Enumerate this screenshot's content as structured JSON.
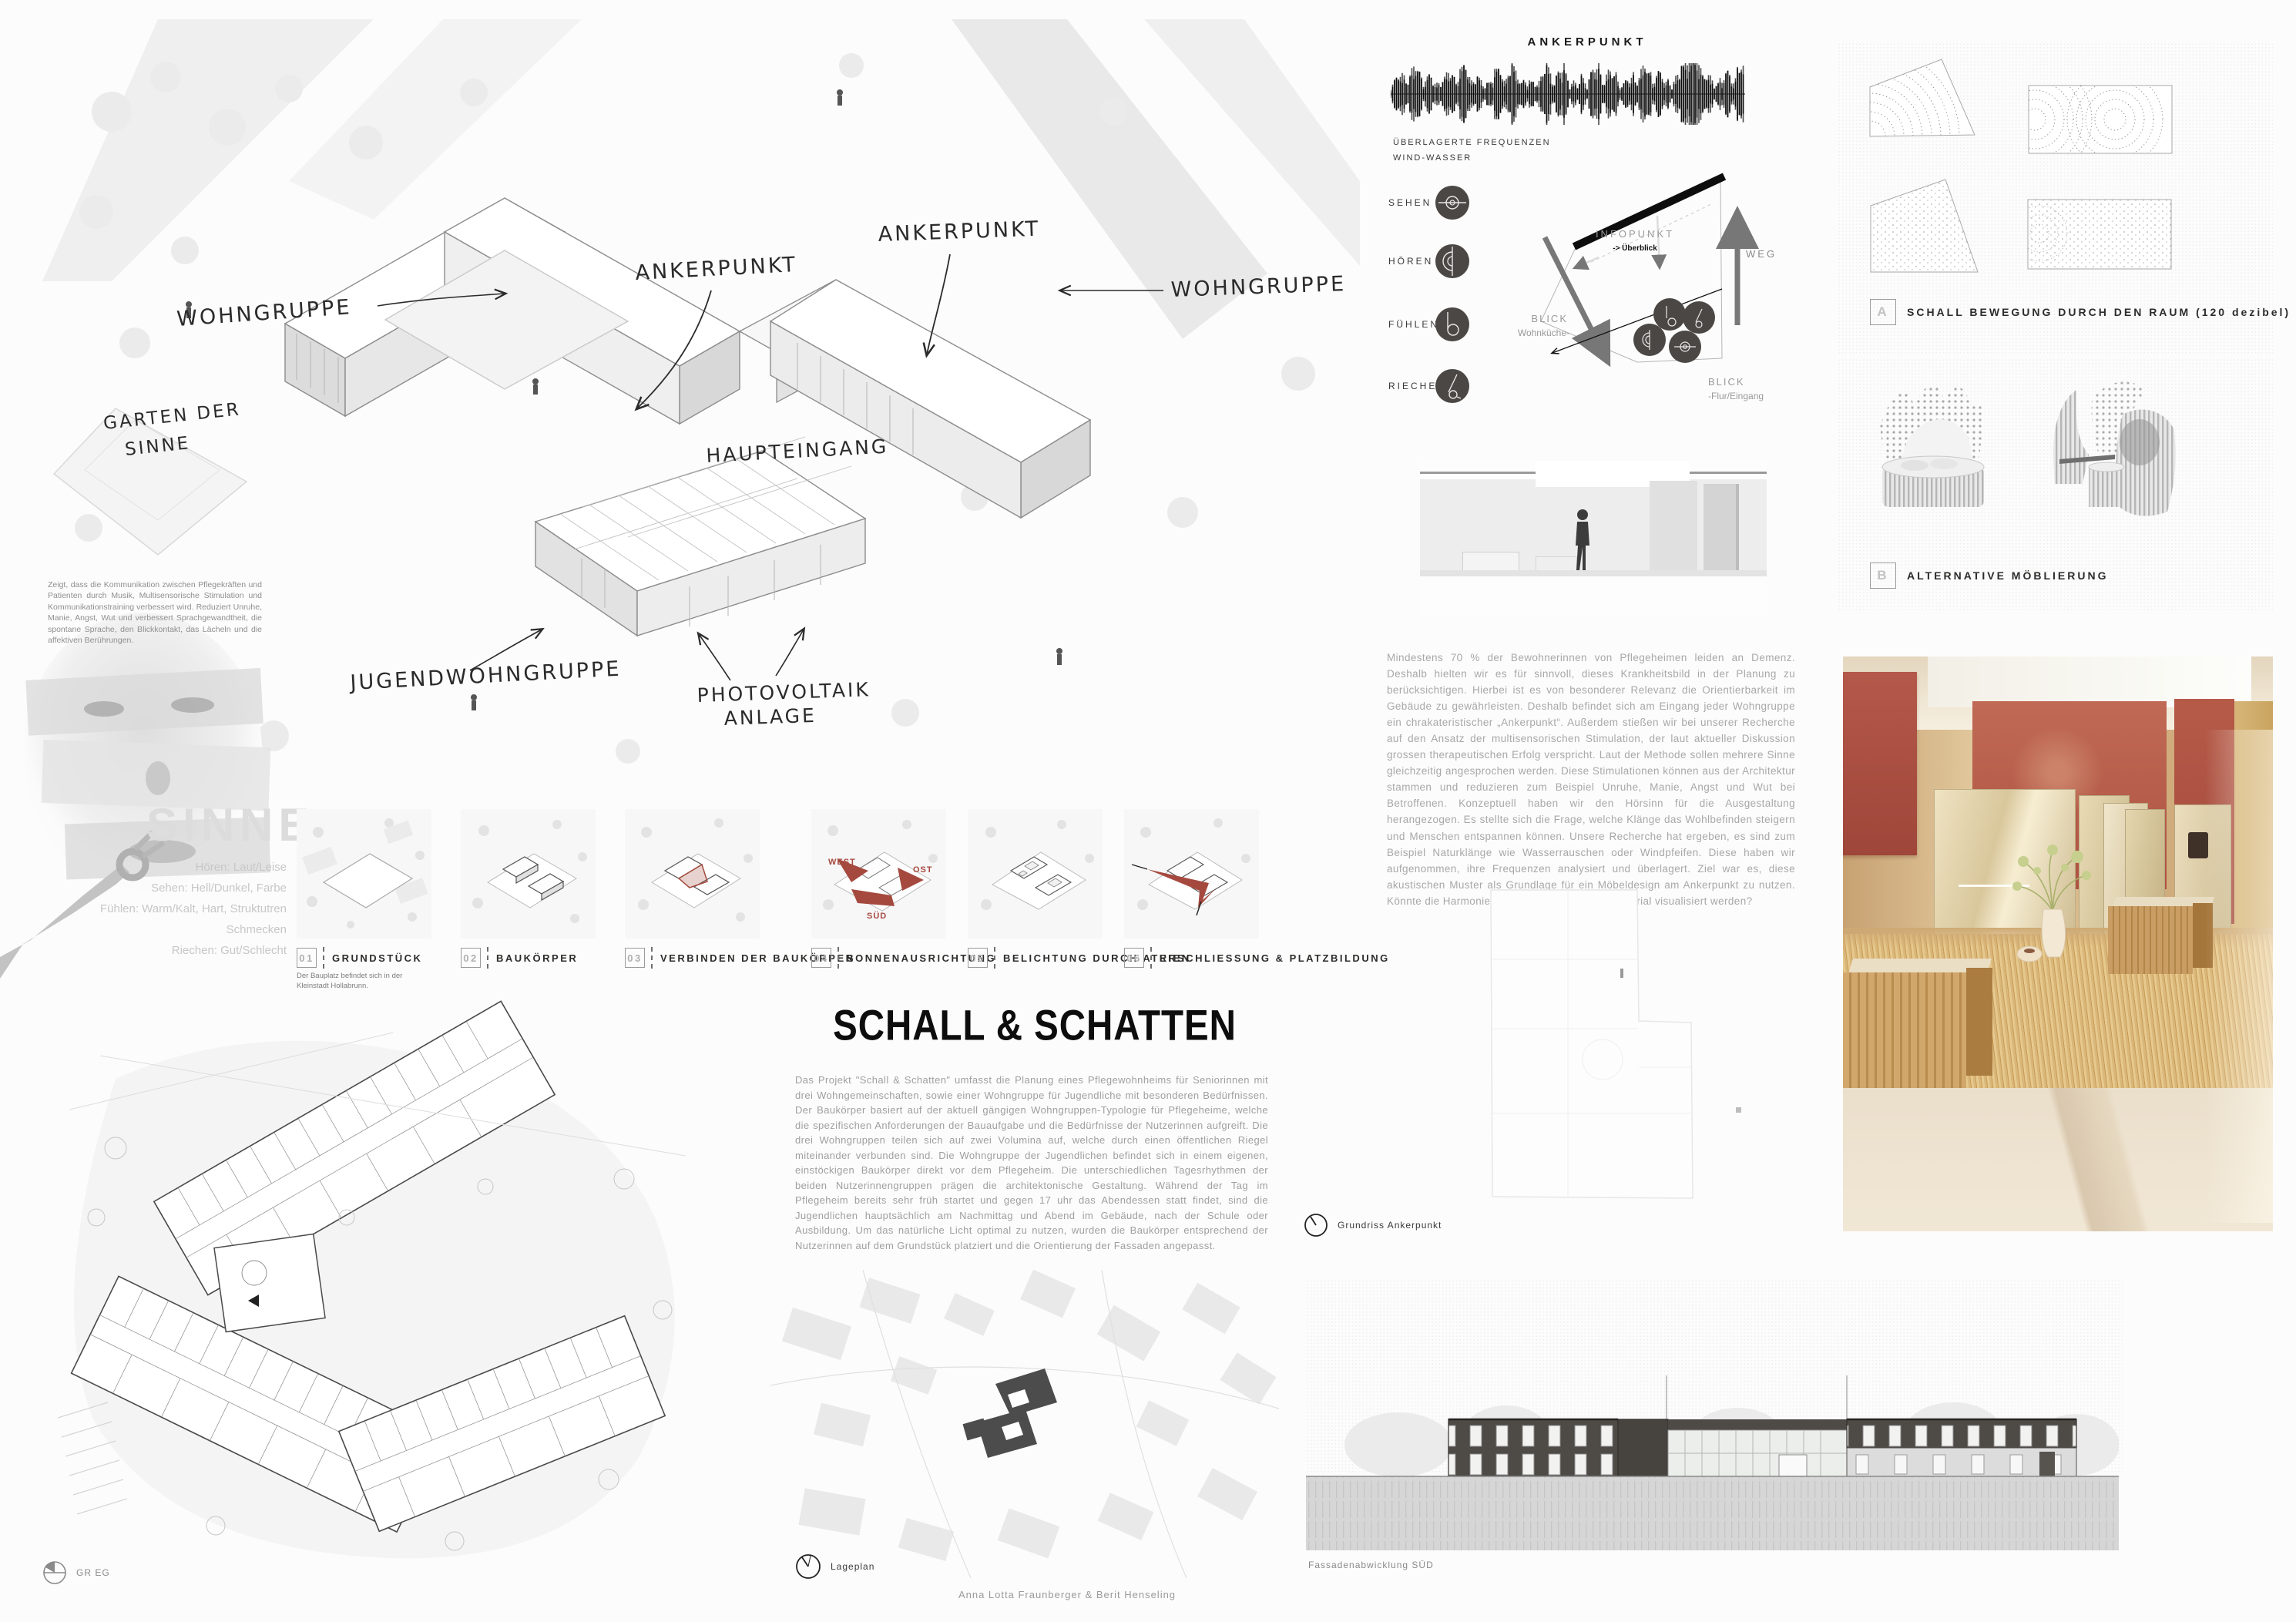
{
  "axon": {
    "wohngruppe_left": "WOHNGRUPPE",
    "ankerpunkt_center": "ANKERPUNKT",
    "ankerpunkt_right": "ANKERPUNKT",
    "wohngruppe_right": "WOHNGRUPPE",
    "haupteingang": "HAUPTEINGANG",
    "garten_line1": "GARTEN DER",
    "garten_line2": "SINNE",
    "jugend": "JUGENDWOHNGRUPPE",
    "pv_line1": "PHOTOVOLTAIK",
    "pv_line2": "ANLAGE"
  },
  "sinne": {
    "note": "Zeigt, dass die Kommunikation zwischen Pflegekräften und Patienten durch Musik, Multisensorische Stimulation und Kommunikationstraining verbessert wird. Reduziert Unruhe, Manie, Angst, Wut und verbessert Sprachgewandtheit, die spontane Sprache, den Blickkontakt, das Lächeln und die affektiven Berührungen.",
    "title": "SINNE",
    "items": [
      "Hören: Laut/Leise",
      "Sehen: Hell/Dunkel, Farbe",
      "Fühlen: Warm/Kalt, Hart, Struktutren",
      "Schmecken",
      "Riechen: Gut/Schlecht"
    ]
  },
  "diagrams": [
    {
      "num": "01",
      "label": "GRUNDSTÜCK",
      "caption": "Der Bauplatz befindet sich in der Kleinstadt Hollabrunn."
    },
    {
      "num": "02",
      "label": "BAUKÖRPER"
    },
    {
      "num": "03",
      "label": "VERBINDEN DER BAUKÖRPER"
    },
    {
      "num": "04",
      "label": "SONNENAUSRICHTUNG",
      "west": "WEST",
      "ost": "OST",
      "sued": "SÜD"
    },
    {
      "num": "05",
      "label": "BELICHTUNG DURCH ATRIEN"
    },
    {
      "num": "06",
      "label": "ERSCHLIESSUNG & PLATZBILDUNG"
    }
  ],
  "main": {
    "title": "SCHALL & SCHATTEN",
    "body": "Das Projekt \"Schall & Schatten\" umfasst die Planung eines Pflegewohnheims für Seniorinnen mit drei Wohngemeinschaften, sowie einer Wohngruppe für Jugendliche mit besonderen Bedürfnissen. Der Baukörper basiert auf der aktuell gängigen Wohngruppen-Typologie für Pflegeheime, welche die spezifischen Anforderungen der Bauaufgabe und die Bedürfnisse der Nutzerinnen aufgreift. Die drei Wohngruppen teilen sich auf zwei Volumina auf, welche durch einen öffentlichen Riegel miteinander verbunden sind. Die Wohngruppe der Jugendlichen befindet sich in einem eigenen, einstöckigen Baukörper direkt vor dem Pflegeheim. Die unterschiedlichen Tagesrhythmen der beiden Nutzerinnengruppen prägen die architektonische Gestaltung. Während der Tag im Pflegeheim bereits sehr früh startet und gegen 17 uhr das Abendessen statt findet, sind die Jugendlichen hauptsächlich am Nachmittag und Abend im Gebäude, nach der Schule oder Ausbildung. Um das natürliche Licht optimal zu nutzen, wurden die Baukörper entsprechend der Nutzerinnen auf dem Grundstück platziert und die Orientierung der Fassaden angepasst."
  },
  "wave": {
    "title": "ANKERPUNKT",
    "caption1": "ÜBERLAGERTE FREQUENZEN",
    "caption2": "WIND-WASSER"
  },
  "senses": {
    "sehen": "SEHEN",
    "hoeren": "HÖREN",
    "fuehlen": "FÜHLEN",
    "riechen": "RIECHEN"
  },
  "infoplan": {
    "infopunkt": "INFOPUNKT",
    "ueberblick": "-> Überblick",
    "weg": "WEG",
    "blick1": "BLICK",
    "blick1b": "Wohnküche-",
    "blick2": "BLICK",
    "blick2b": "-Flur/Eingang"
  },
  "research": {
    "body": "Mindestens 70 % der Bewohnerinnen von Pflegeheimen leiden an Demenz. Deshalb hielten wir es für sinnvoll, dieses Krankheitsbild in der Planung zu berücksichtigen. Hierbei ist es von besonderer Relevanz die Orientierbarkeit im Gebäude zu gewährleisten. Deshalb befindet sich am Eingang jeder Wohngruppe ein chrakateristischer „Ankerpunkt“. Außerdem stießen wir bei unserer Recherche auf den Ansatz der multisensorischen Stimulation, der laut aktueller Diskussion grossen therapeutischen Erfolg verspricht. Laut der Methode sollen mehrere Sinne gleichzeitig angesprochen werden. Diese Stimulationen können aus der Architektur stammen und reduzieren zum Beispiel Unruhe, Manie, Angst und Wut bei Betroffenen. Konzeptuell haben wir den Hörsinn für die Ausgestaltung herangezogen. Es stellte sich die Frage, welche Klänge das Wohlbefinden steigern und Menschen entspannen können. Unsere Recherche hat ergeben, es sind zum Beispiel Naturklänge wie Wasserrauschen oder Windpfeifen. Diese haben wir aufgenommen, ihre Frequenzen analysiert und überlagert. Ziel war es, diese akustischen Muster als Grundlage für ein Möbeldesign am Ankerpunkt zu nutzen. Könnte die Harmonie der Klänge in Form und Material visualisiert werden?"
  },
  "labels": {
    "grundriss": "Grundriss Ankerpunkt",
    "gr_eg": "GR EG",
    "lageplan": "Lageplan",
    "fassade": "Fassadenabwicklung SÜD"
  },
  "studies": {
    "a_tag": "A",
    "a_label": "SCHALL BEWEGUNG DURCH DEN RAUM (120 dezibel)",
    "b_tag": "B",
    "b_label": "ALTERNATIVE MÖBLIERUNG"
  },
  "credit": "Anna Lotta Fraunberger & Berit Henseling",
  "colors": {
    "accent_red": "#a34a3e",
    "render_red": "#b85c4a",
    "render_tan": "#d8b88c",
    "ink": "#1a1a1a"
  }
}
